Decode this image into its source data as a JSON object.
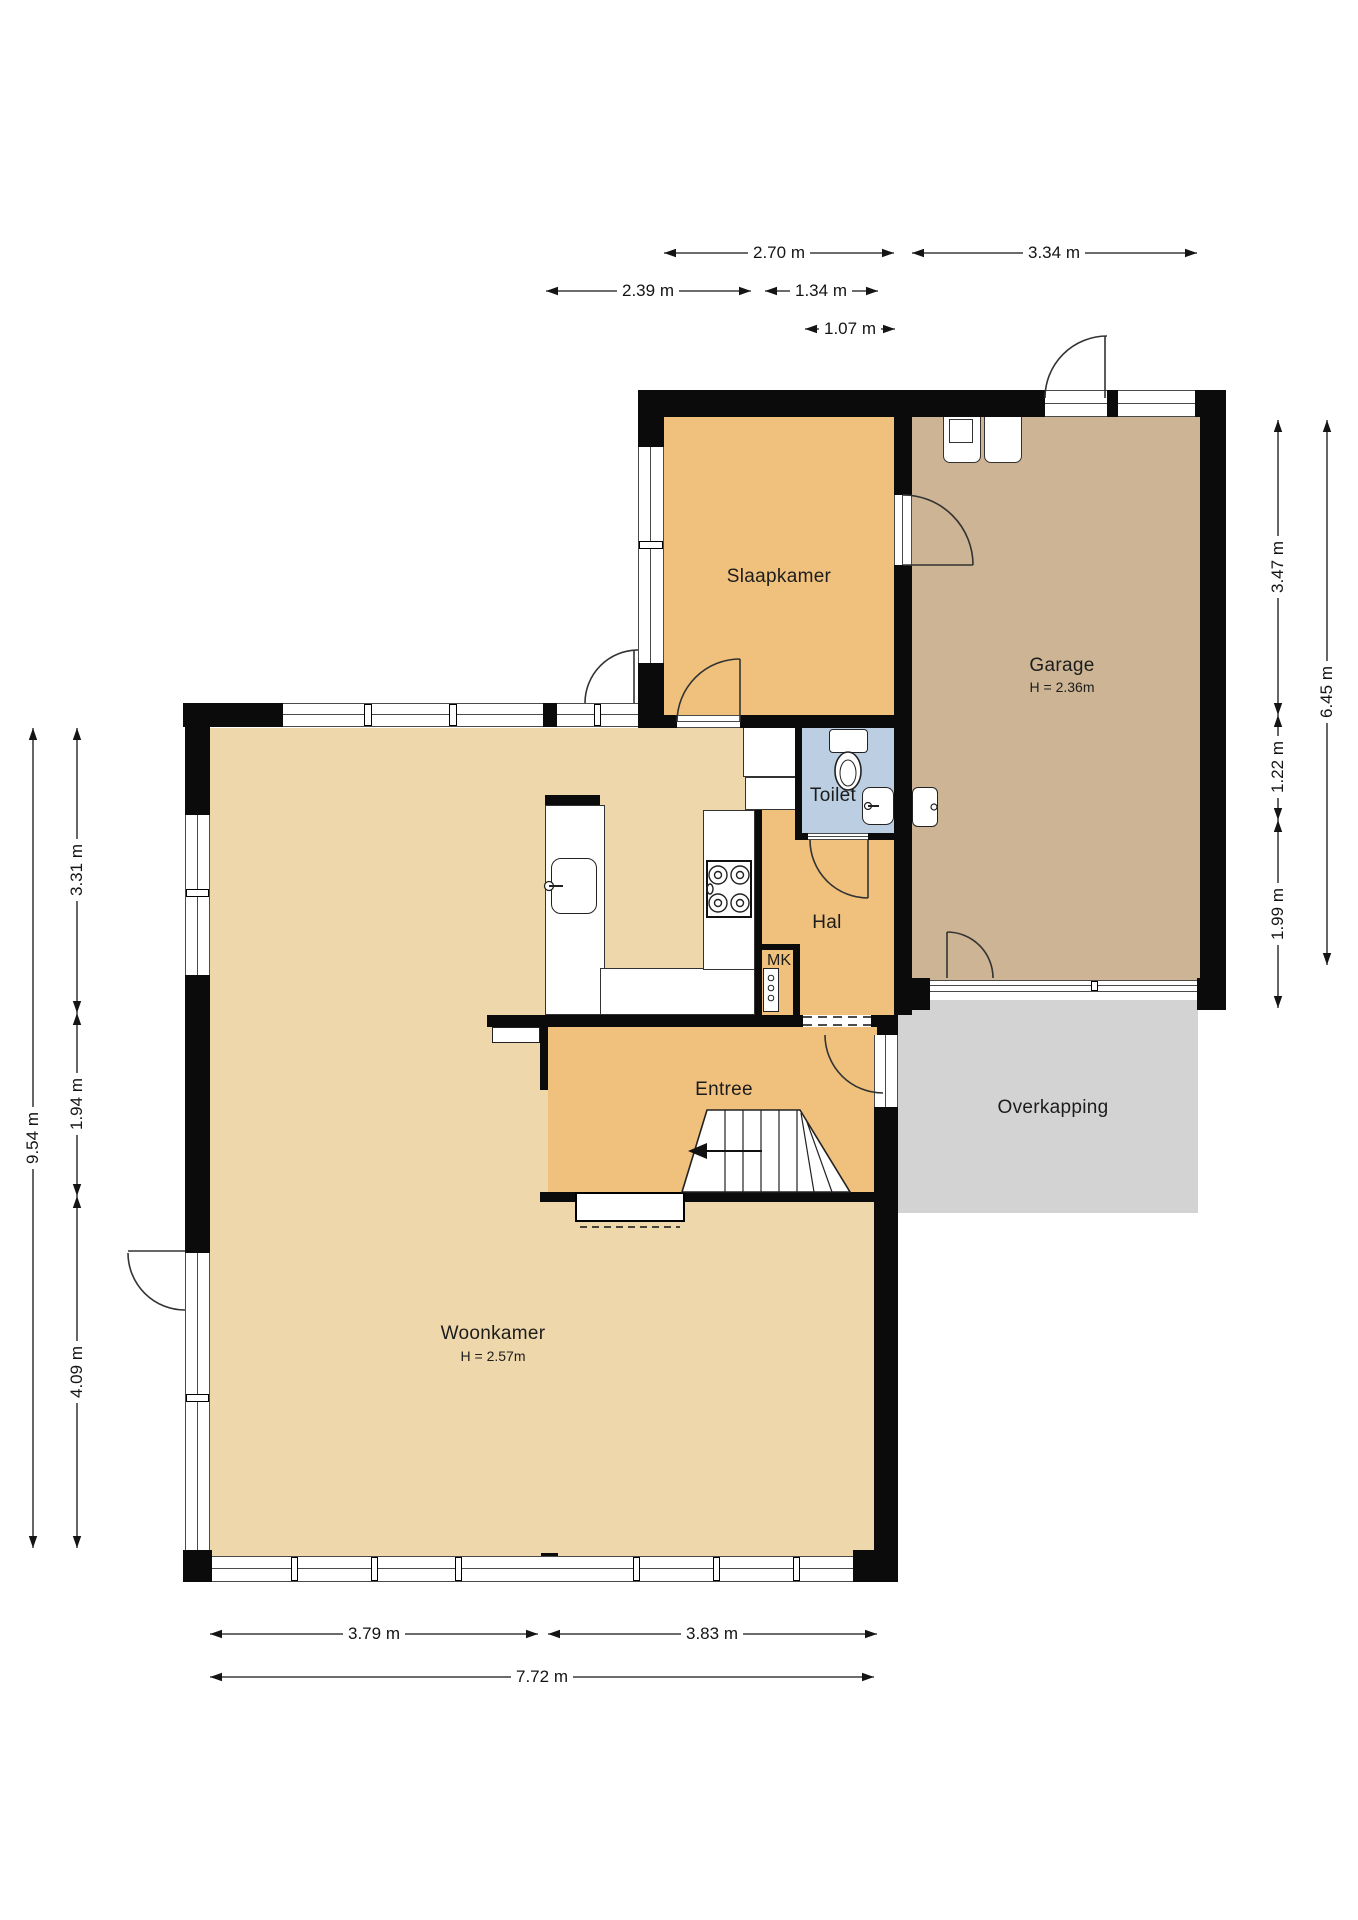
{
  "plan": {
    "type": "floorplan-ground-floor",
    "language": "nl"
  },
  "rooms": {
    "slaapkamer": {
      "label": "Slaapkamer"
    },
    "garage": {
      "label": "Garage",
      "height_note": "H = 2.36m"
    },
    "toilet": {
      "label": "Toilet"
    },
    "hal": {
      "label": "Hal"
    },
    "meterkast": {
      "label": "MK"
    },
    "entree": {
      "label": "Entree"
    },
    "woonkamer": {
      "label": "Woonkamer",
      "height_note": "H = 2.57m"
    },
    "overkapping": {
      "label": "Overkapping"
    }
  },
  "dims": {
    "w270": "2.70 m",
    "w334": "3.34 m",
    "w239": "2.39 m",
    "w134": "1.34 m",
    "w107": "1.07 m",
    "w379": "3.79 m",
    "w383": "3.83 m",
    "w772": "7.72 m",
    "h331": "3.31 m",
    "h194": "1.94 m",
    "h409": "4.09 m",
    "h954": "9.54 m",
    "h347": "3.47 m",
    "h122": "1.22 m",
    "h199": "1.99 m",
    "h645": "6.45 m"
  },
  "colors": {
    "wall": "#0b0b0b",
    "bedroom_hall_entry_orange": "#efc17d",
    "living_kitchen_beige": "#eed7ab",
    "garage_tan": "#ccb494",
    "toilet_blue": "#bccfe2",
    "canopy_gray": "#d3d3d3",
    "background": "#ffffff",
    "dimension_text": "#141414"
  }
}
